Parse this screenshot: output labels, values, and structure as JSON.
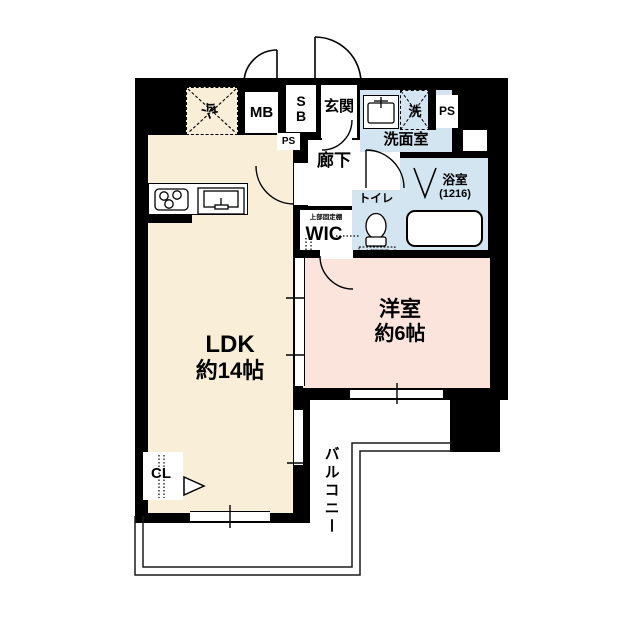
{
  "plan_title": "1LDK apartment floor plan",
  "colors": {
    "wall": "#000000",
    "ldk_fill": "#f9efd9",
    "western_room_fill": "#fae4dc",
    "wet_area_fill": "#d3e5f1",
    "background": "#ffffff"
  },
  "rooms": {
    "ldk": {
      "name": "LDK",
      "size": "約14帖"
    },
    "western_room": {
      "name": "洋室",
      "size": "約6帖"
    },
    "entrance": {
      "name": "玄関"
    },
    "hallway": {
      "name": "廊下"
    },
    "washroom": {
      "name": "洗面室"
    },
    "bathroom": {
      "name": "浴室",
      "size": "(1216)"
    },
    "toilet": {
      "name": "トイレ",
      "shelf_note": "上部吊戸棚"
    },
    "wic": {
      "name": "WIC",
      "shelf_note": "上部固定棚"
    },
    "closet": {
      "name": "CL"
    },
    "balcony": {
      "name": "バルコニー"
    },
    "meter_box": {
      "name": "MB"
    },
    "shoe_box": {
      "line1": "S",
      "line2": "B"
    },
    "pipe_space_top": {
      "name": "PS"
    },
    "pipe_space_small": {
      "name": "PS"
    },
    "washer_space": {
      "name": "洗"
    },
    "fridge_space": {
      "name": "冷"
    }
  }
}
